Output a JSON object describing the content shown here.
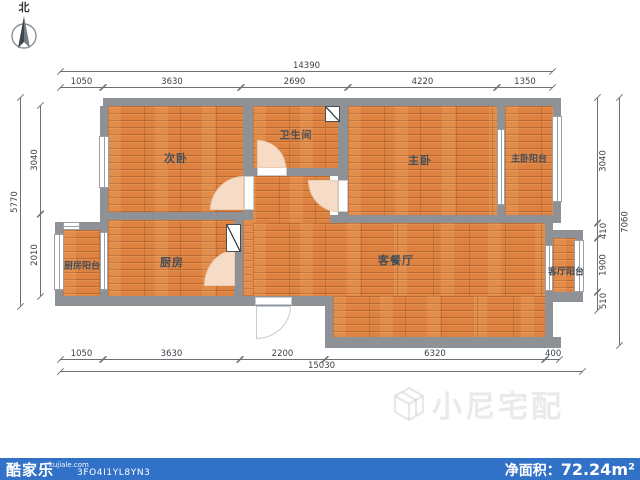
{
  "north": {
    "label": "北"
  },
  "rooms": {
    "second_bedroom": "次卧",
    "bathroom": "卫生间",
    "master_bedroom": "主卧",
    "master_balcony": "主卧阳台",
    "kitchen": "厨房",
    "kitchen_balcony": "厨房阳台",
    "living_dining": "客餐厅",
    "living_balcony": "客厅阳台"
  },
  "dimensions": {
    "top": {
      "overall": "14390",
      "segments": [
        "1050",
        "3630",
        "2690",
        "4220",
        "1350"
      ]
    },
    "bottom": {
      "overall": "15030",
      "segments": [
        "1050",
        "3630",
        "2200",
        "6320",
        "400"
      ]
    },
    "left": {
      "overall": "5770",
      "segments": [
        "3040",
        "2010"
      ]
    },
    "right": {
      "overall": "7060",
      "segments": [
        "3040",
        "410",
        "1900",
        "510"
      ]
    }
  },
  "watermark": {
    "brand": "小尼宅配"
  },
  "footer": {
    "brand": "酷家乐",
    "domain": "kujiale.com",
    "code": "3FO4I1YL8YN3",
    "area_label": "净面积：",
    "area_value": "72.24m²"
  },
  "colors": {
    "wall": "#8e9296",
    "floor": "#de8241",
    "footer_bar": "#3271c8",
    "dim_line": "#6b7075"
  }
}
